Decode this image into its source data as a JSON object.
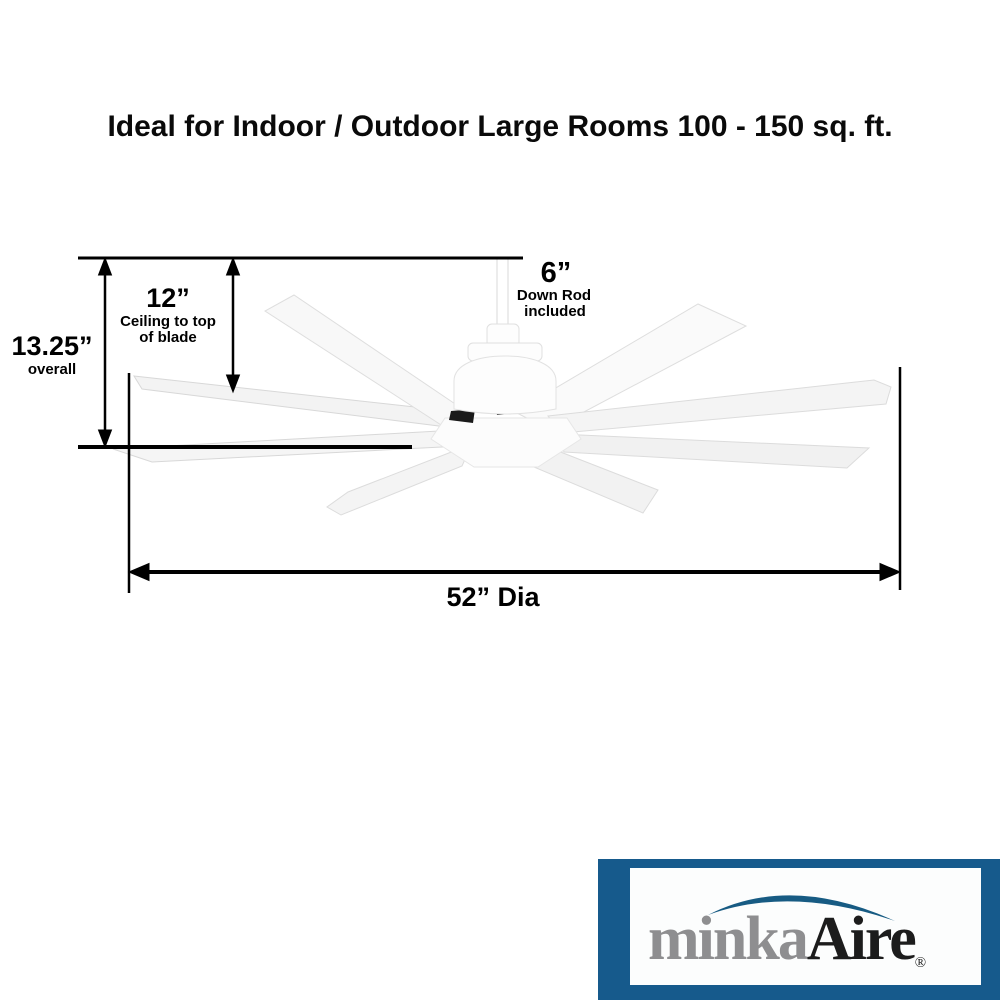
{
  "title": "Ideal for Indoor / Outdoor Large Rooms 100 - 150 sq. ft.",
  "dimensions": {
    "overall": {
      "value": "13.25”",
      "label": "overall"
    },
    "ceiling_to_blade": {
      "value": "12”",
      "line1": "Ceiling to top",
      "line2": "of blade"
    },
    "down_rod": {
      "value": "6”",
      "line1": "Down Rod",
      "line2": "included"
    },
    "diameter": {
      "value": "52” Dia"
    }
  },
  "fan": {
    "blade_count": 8,
    "finish_color": "#ffffff"
  },
  "logo": {
    "brand_gray": "minka",
    "brand_black": "Aire",
    "registered_mark": "®",
    "panel_color": "#165a8c",
    "box_color": "#fcfdfd",
    "gray_text_color": "#8e8e90",
    "black_text_color": "#1c1c1c",
    "arc_color": "#175b83"
  },
  "colors": {
    "background": "#ffffff",
    "dimension_lines": "#000000"
  }
}
